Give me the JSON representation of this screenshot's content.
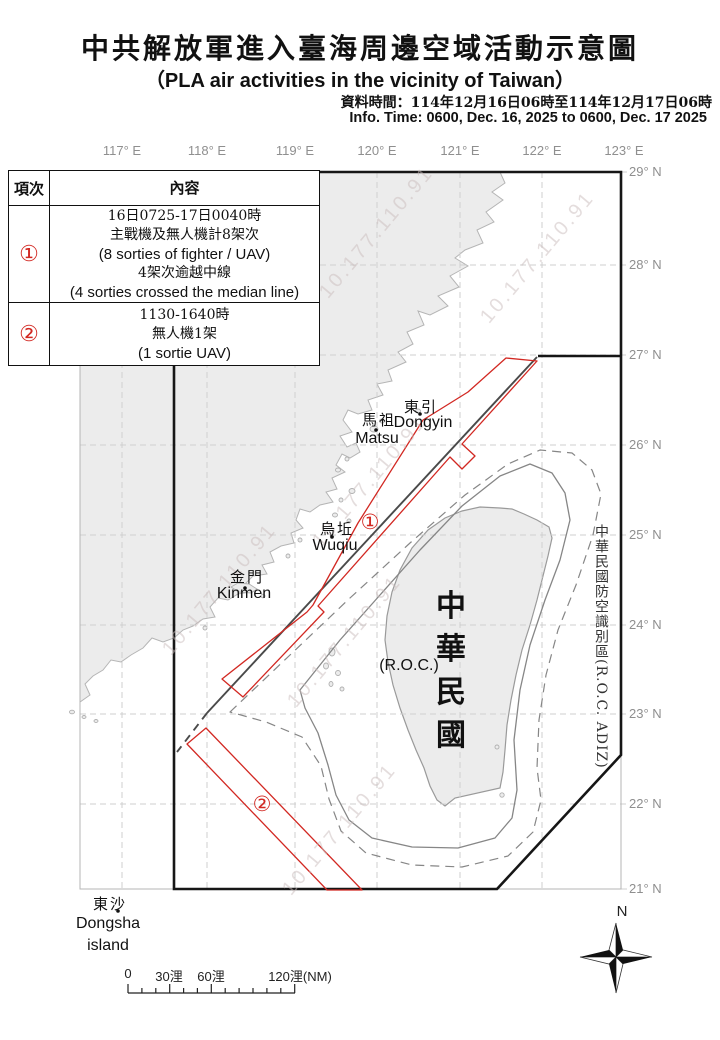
{
  "header": {
    "title": "中共解放軍進入臺海周邊空域活動示意圖",
    "subtitle": "（PLA air activities in the vicinity of Taiwan）",
    "info_line_zh": "資料時間：114年12月16日06時至114年12月17日06時",
    "info_line_en": "Info. Time: 0600, Dec. 16, 2025 to 0600, Dec. 17 2025"
  },
  "legend_table": {
    "col_item": "項次",
    "col_content": "內容",
    "rows": [
      {
        "num": "①",
        "lines": [
          "16日0725-17日0040時",
          "主戰機及無人機計8架次",
          "(8 sorties of fighter / UAV)",
          "4架次逾越中線",
          "(4 sorties crossed the median line)"
        ]
      },
      {
        "num": "②",
        "lines": [
          "1130-1640時",
          "無人機1架",
          "(1 sortie UAV)"
        ]
      }
    ]
  },
  "map": {
    "lon_labels": [
      "117° E",
      "118° E",
      "119° E",
      "120° E",
      "121° E",
      "122° E",
      "123° E"
    ],
    "lat_labels": [
      "29° N",
      "28° N",
      "27° N",
      "26° N",
      "25° N",
      "24° N",
      "23° N",
      "22° N",
      "21° N"
    ],
    "places": {
      "dongyin_zh": "東引",
      "dongyin_en": "Dongyin",
      "matsu_zh": "馬祖",
      "matsu_en": "Matsu",
      "wuqiu_zh": "烏坵",
      "wuqiu_en": "Wuqiu",
      "kinmen_zh": "金門",
      "kinmen_en": "Kinmen",
      "dongsha_zh": "東沙",
      "dongsha_en1": "Dongsha",
      "dongsha_en2": "island"
    },
    "taiwan": {
      "name_zh": "中華民國",
      "name_en": "(R.O.C.)"
    },
    "adiz_label": "中華民國防空識別區(R.O.C. ADIZ)",
    "corridor1_label": "①",
    "corridor2_label": "②",
    "compass_n": "N",
    "scale_bar": {
      "t0": "0",
      "t30": "30浬",
      "t60": "60浬",
      "t120": "120浬(NM)"
    },
    "watermark_text": "10.177.110.91"
  },
  "colors": {
    "accent_red": "#d22822",
    "land_fill": "#ececec",
    "coast_stroke": "#b5b5b5",
    "grid": "#cfcfcf",
    "frame_black": "#161616",
    "median_gray": "#4a4a4a",
    "contour_gray": "#868686",
    "label_gray": "#8f8f8f"
  }
}
